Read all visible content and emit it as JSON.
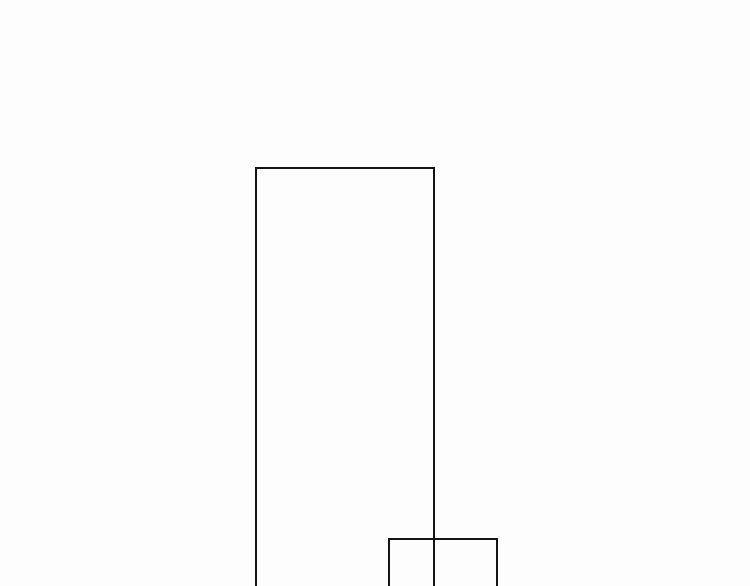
{
  "canvas": {
    "width": 750,
    "height": 586,
    "background": "#fdfdfd"
  },
  "shapes": [
    {
      "name": "large-panel-rectangle",
      "type": "rectangle-outline",
      "x": 255,
      "y": 167,
      "width": 180,
      "height": 419,
      "stroke": "#141414",
      "stroke_width": 2,
      "fill": "none",
      "clipped_at_bottom": true
    },
    {
      "name": "small-panel-rectangle",
      "type": "rectangle-outline",
      "x": 388,
      "y": 538,
      "width": 110,
      "height": 48,
      "stroke": "#141414",
      "stroke_width": 2,
      "fill": "none",
      "clipped_at_bottom": true
    }
  ]
}
